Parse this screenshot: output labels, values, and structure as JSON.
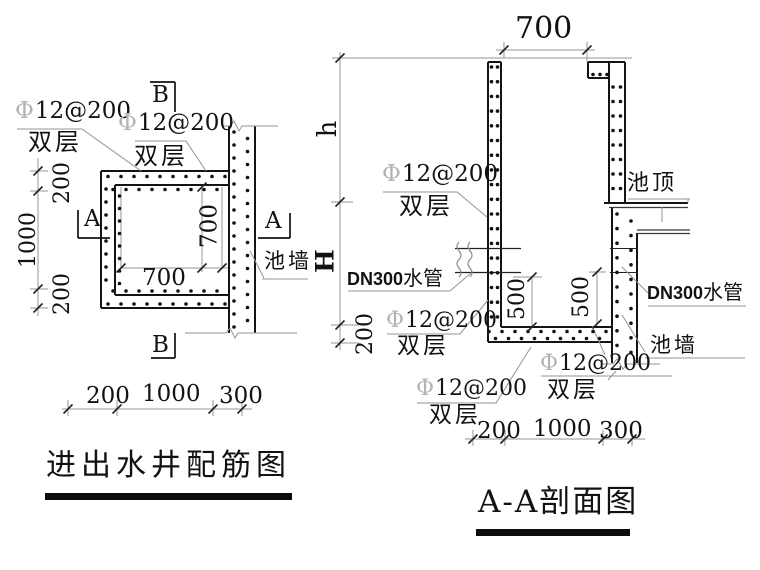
{
  "plan": {
    "title": "进出水井配筋图",
    "marks": {
      "b_top": "B",
      "b_bottom": "B",
      "a_left": "A",
      "a_right": "A"
    },
    "rebar_labels": [
      {
        "symbol": "Φ",
        "spec": "12@200",
        "layer": "双层"
      },
      {
        "symbol": "Φ",
        "spec": "12@200",
        "layer": "双层"
      }
    ],
    "wall_label": "池墙",
    "dims": {
      "left_top": "200",
      "left_mid": "1000",
      "left_bottom": "200",
      "inner_width": "700",
      "inner_height": "700",
      "bottom": [
        "200",
        "1000",
        "300"
      ]
    }
  },
  "section": {
    "title": "A-A剖面图",
    "roof_label": "池顶",
    "wall_label": "池墙",
    "pipe_left": {
      "code": "DN300",
      "text": "水管"
    },
    "pipe_right": {
      "code": "DN300",
      "text": "水管"
    },
    "rebar_labels": [
      {
        "symbol": "Φ",
        "spec": "12@200",
        "layer": "双层"
      },
      {
        "symbol": "Φ",
        "spec": "12@200",
        "layer": "双层"
      },
      {
        "symbol": "Φ",
        "spec": "12@200",
        "layer": "双层"
      },
      {
        "symbol": "Φ",
        "spec": "12@200",
        "layer": "双层"
      }
    ],
    "dims": {
      "top": "700",
      "h": "h",
      "H": "H",
      "left_bottom": "200",
      "inner_left": "500",
      "inner_right": "500",
      "bottom": [
        "200",
        "1000",
        "300"
      ]
    }
  },
  "colors": {
    "line": "#141414",
    "dim": "#949494",
    "rebar_symbol": "#b3b3b3",
    "text": "#121212"
  }
}
